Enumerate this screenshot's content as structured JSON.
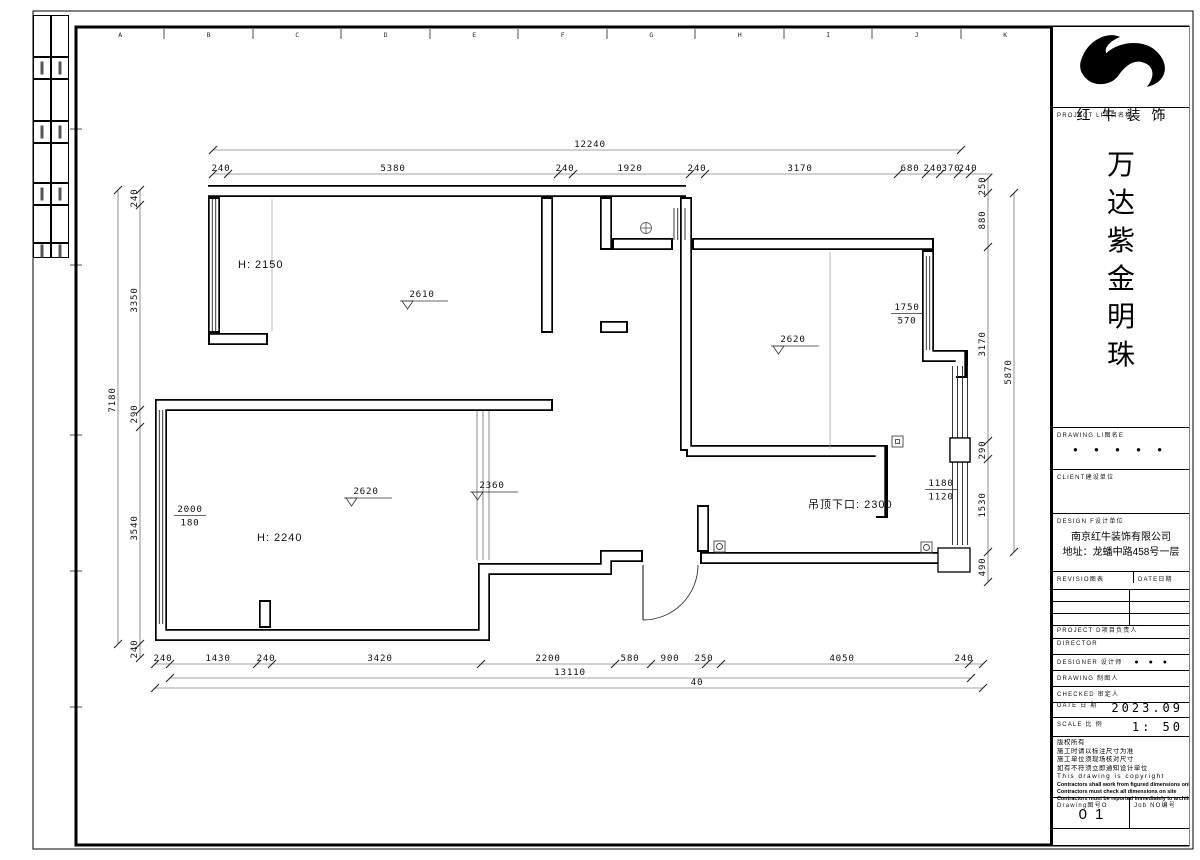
{
  "sheet": {
    "border_letters": [
      "A",
      "B",
      "C",
      "D",
      "E",
      "F",
      "G",
      "H",
      "I",
      "J",
      "K"
    ]
  },
  "title_block": {
    "company_name": "红牛装饰",
    "project_label": "PROJECT LI项目名称",
    "project_title_chars": [
      "万",
      "达",
      "紫",
      "金",
      "明",
      "珠"
    ],
    "drawing_list_label": "DRAWING LI图名E",
    "drawing_list_dots": "● ● ● ● ●",
    "client_label": "CLIENT建设单位",
    "design_firm_label": "DESIGN F设计单位",
    "design_firm_name": "南京红牛装饰有限公司",
    "design_firm_address": "地址：龙蟠中路458号一层",
    "revision_label": "REVISIO图表",
    "revision_date_label": "DATE日期",
    "staff_rows": [
      {
        "label": "PROJECT D项目负责人",
        "value": ""
      },
      {
        "label": "DIRECTOR",
        "value": ""
      },
      {
        "label": "DESIGNER 设计师",
        "value": "● ● ●"
      },
      {
        "label": "DRAWING 制图人",
        "value": ""
      },
      {
        "label": "CHECKED 审定人",
        "value": ""
      }
    ],
    "date_label": "DATE 日 期",
    "date_value": "2023.09",
    "scale_label": "SCALE 比 例",
    "scale_value": "1: 50",
    "notes": [
      "版权所有",
      "施工时请以标注尺寸为准",
      "施工单位须现场核对尺寸",
      "如有不符须立即通知设计单位",
      "This drawing is copyright"
    ],
    "notes_bold": [
      "Contractors shall work from figured dimensions only",
      "Contractors must check all dimensions on site",
      "Contractors must be reported immediately to architects"
    ],
    "drawing_no_label": "Drawing图号O",
    "drawing_no_value": "01",
    "job_no_label": "Job NO编号"
  },
  "plan": {
    "plain_labels": [
      {
        "t": "H: 2150",
        "x": 238,
        "y": 268,
        "size": 11
      },
      {
        "t": "H: 2240",
        "x": 257,
        "y": 541,
        "size": 11
      },
      {
        "t": "吊顶下口: 2300",
        "x": 808,
        "y": 508,
        "size": 11
      }
    ],
    "elevation_markers": [
      {
        "t": "2610",
        "x": 422,
        "y": 297
      },
      {
        "t": "2620",
        "x": 793,
        "y": 342
      },
      {
        "t": "2620",
        "x": 366,
        "y": 494
      },
      {
        "t": "2360",
        "x": 492,
        "y": 488
      }
    ],
    "stacked_labels": [
      {
        "top": "1750",
        "bottom": "570",
        "x": 907,
        "y": 310
      },
      {
        "top": "2000",
        "bottom": "180",
        "x": 190,
        "y": 512
      },
      {
        "top": "1180",
        "bottom": "1120",
        "x": 941,
        "y": 486
      }
    ],
    "dim_chains": [
      {
        "o": "h",
        "line": 150,
        "x1": 213,
        "x2": 961,
        "ticks": [
          213,
          961
        ],
        "ly": 147,
        "labels": [
          {
            "t": "12240",
            "at": 590
          }
        ]
      },
      {
        "o": "h",
        "line": 174,
        "x1": 213,
        "x2": 993,
        "ticks": [
          213,
          228,
          558,
          573,
          690,
          705,
          898,
          926,
          940,
          958,
          970
        ],
        "ly": 171,
        "labels": [
          {
            "t": "240",
            "at": 221
          },
          {
            "t": "5380",
            "at": 393
          },
          {
            "t": "240",
            "at": 565
          },
          {
            "t": "1920",
            "at": 630
          },
          {
            "t": "240",
            "at": 697
          },
          {
            "t": "3170",
            "at": 800
          },
          {
            "t": "680",
            "at": 910
          },
          {
            "t": "240",
            "at": 933
          },
          {
            "t": "370",
            "at": 951
          },
          {
            "t": "240",
            "at": 968
          }
        ]
      },
      {
        "o": "v",
        "line": 118,
        "y1": 190,
        "y2": 644,
        "ticks": [
          190,
          644
        ],
        "lx": 115,
        "labels": [
          {
            "t": "7180",
            "at": 400
          }
        ]
      },
      {
        "o": "v",
        "line": 140,
        "y1": 190,
        "y2": 658,
        "ticks": [
          190,
          205,
          410,
          427,
          644,
          658
        ],
        "lx": 137,
        "labels": [
          {
            "t": "240",
            "at": 198
          },
          {
            "t": "3350",
            "at": 300
          },
          {
            "t": "290",
            "at": 414
          },
          {
            "t": "3540",
            "at": 528
          },
          {
            "t": "240",
            "at": 649
          }
        ]
      },
      {
        "o": "v",
        "line": 988,
        "y1": 178,
        "y2": 582,
        "ticks": [
          178,
          193,
          247,
          441,
          459,
          552,
          582
        ],
        "lx": 985,
        "labels": [
          {
            "t": "250",
            "at": 186
          },
          {
            "t": "880",
            "at": 220
          },
          {
            "t": "3170",
            "at": 344
          },
          {
            "t": "290",
            "at": 450
          },
          {
            "t": "1530",
            "at": 505
          },
          {
            "t": "490",
            "at": 567
          }
        ]
      },
      {
        "o": "v",
        "line": 1014,
        "y1": 193,
        "y2": 552,
        "ticks": [
          193,
          552
        ],
        "lx": 1011,
        "labels": [
          {
            "t": "5870",
            "at": 372
          }
        ]
      },
      {
        "o": "h",
        "line": 664,
        "x1": 155,
        "x2": 983,
        "ticks": [
          155,
          170,
          257,
          272,
          481,
          615,
          651,
          706,
          721,
          969,
          983
        ],
        "ly": 661,
        "labels": [
          {
            "t": "240",
            "at": 163
          },
          {
            "t": "1430",
            "at": 218
          },
          {
            "t": "240",
            "at": 266
          },
          {
            "t": "3420",
            "at": 380
          },
          {
            "t": "2200",
            "at": 548
          },
          {
            "t": "580",
            "at": 630
          },
          {
            "t": "900",
            "at": 670
          },
          {
            "t": "250",
            "at": 704
          },
          {
            "t": "4050",
            "at": 842
          },
          {
            "t": "240",
            "at": 964
          }
        ]
      },
      {
        "o": "h",
        "line": 678,
        "x1": 170,
        "x2": 971,
        "ticks": [
          170,
          971
        ],
        "ly": 675,
        "labels": [
          {
            "t": "13110",
            "at": 570
          }
        ]
      },
      {
        "o": "h",
        "line": 688,
        "x1": 155,
        "x2": 983,
        "ticks": [
          155,
          983
        ],
        "ly": 685,
        "labels": [
          {
            "t": "40",
            "at": 697
          }
        ]
      }
    ]
  }
}
